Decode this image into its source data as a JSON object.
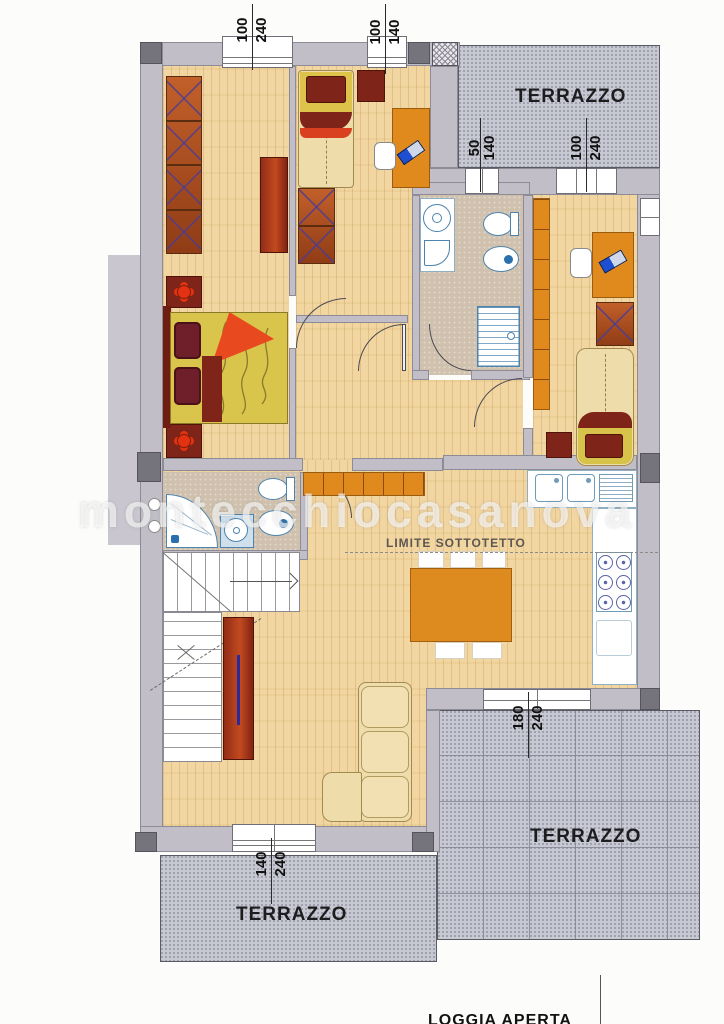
{
  "watermark": "montecchiocasanova",
  "labels": {
    "terrazzo": "TERRAZZO",
    "limite_sottotetto": "LIMITE SOTTOTETTO",
    "loggia_aperta": "LOGGIA APERTA"
  },
  "dimensions": {
    "master_window": {
      "a": "100",
      "b": "240"
    },
    "cameretta_window": {
      "a": "100",
      "b": "140"
    },
    "terrace_door_small": {
      "a": "50",
      "b": "140"
    },
    "terrace_door_large": {
      "a": "100",
      "b": "240"
    },
    "terrace_south_door": {
      "a": "180",
      "b": "240"
    },
    "loggia_window": {
      "a": "140",
      "b": "240"
    }
  },
  "colors": {
    "wall": "#c1bec7",
    "pillar": "#75737c",
    "wood_floor": "#f2d6a2",
    "bath_floor": "#cfc1ad",
    "terrace": "#c7c8d1",
    "furniture_orange": "#e0891d",
    "furniture_rust": "#b5521f",
    "maroon": "#7e2418",
    "bed_yellow": "#ddc34a",
    "accent_red": "#e33212",
    "fixture_blue": "#4d83ad",
    "sofa_cream": "#efdcab"
  }
}
